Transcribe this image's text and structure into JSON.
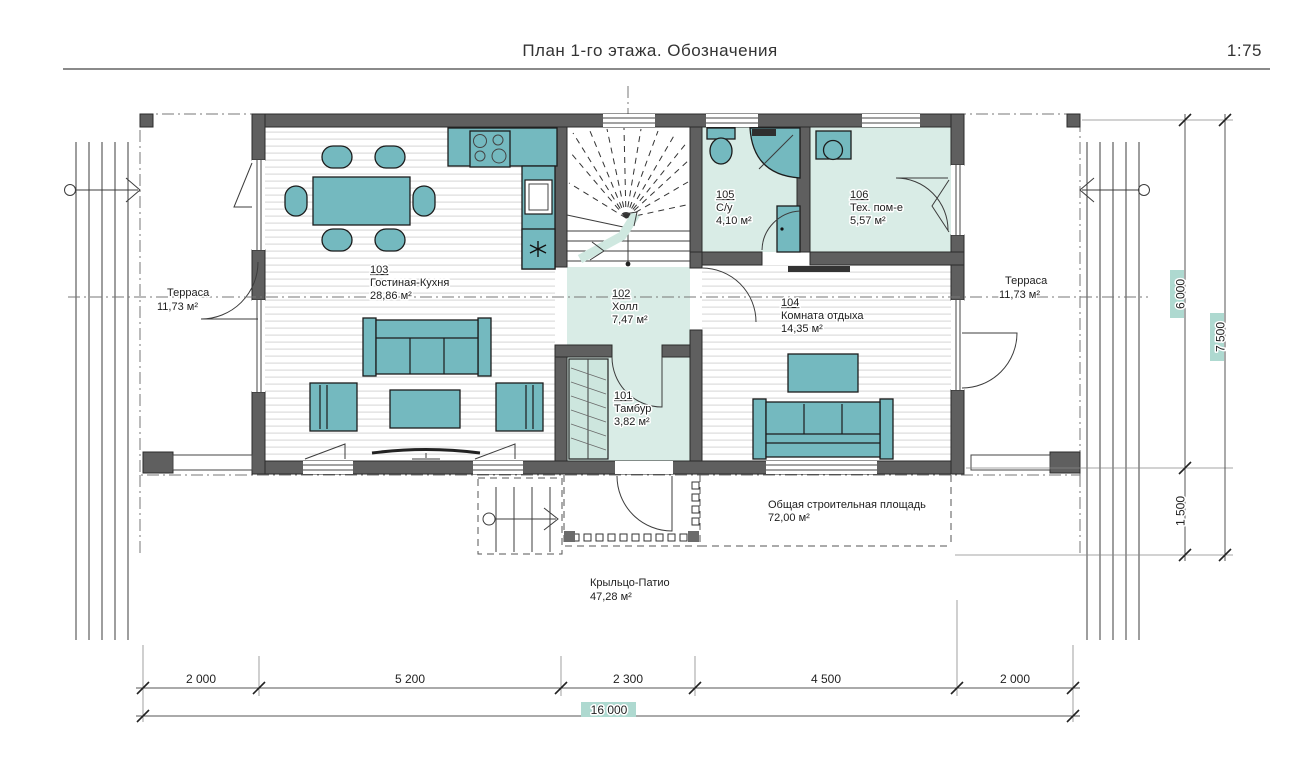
{
  "header": {
    "title": "План 1-го этажа. Обозначения",
    "scale": "1:75"
  },
  "rooms": [
    {
      "number": "101",
      "name": "Тамбур",
      "area": "3,82 м²"
    },
    {
      "number": "102",
      "name": "Холл",
      "area": "7,47 м²"
    },
    {
      "number": "103",
      "name": "Гостиная-Кухня",
      "area": "28,86 м²"
    },
    {
      "number": "104",
      "name": "Комната отдыха",
      "area": "14,35 м²"
    },
    {
      "number": "105",
      "name": "С/у",
      "area": "4,10 м²"
    },
    {
      "number": "106",
      "name": "Тех. пом-е",
      "area": "5,57 м²"
    }
  ],
  "outdoor": {
    "terrace_left": {
      "name": "Терраса",
      "area": "11,73 м²"
    },
    "terrace_right": {
      "name": "Терраса",
      "area": "11,73 м²"
    },
    "porch": {
      "name": "Крыльцо-Патио",
      "area": "47,28 м²"
    },
    "total_area": {
      "name": "Общая строительная площадь",
      "area": "72,00 м²"
    }
  },
  "dimensions": {
    "bottom_segments": [
      "2 000",
      "5 200",
      "2 300",
      "4 500",
      "2 000"
    ],
    "bottom_total": "16 000",
    "right_segments": [
      "6 000",
      "1 500"
    ],
    "right_total": "7 500"
  },
  "colors": {
    "furniture": "#74b9bf",
    "floor_tint": "#d9ece6",
    "wall": "#5f5f5f",
    "dim_highlight": "#aed9d0"
  }
}
